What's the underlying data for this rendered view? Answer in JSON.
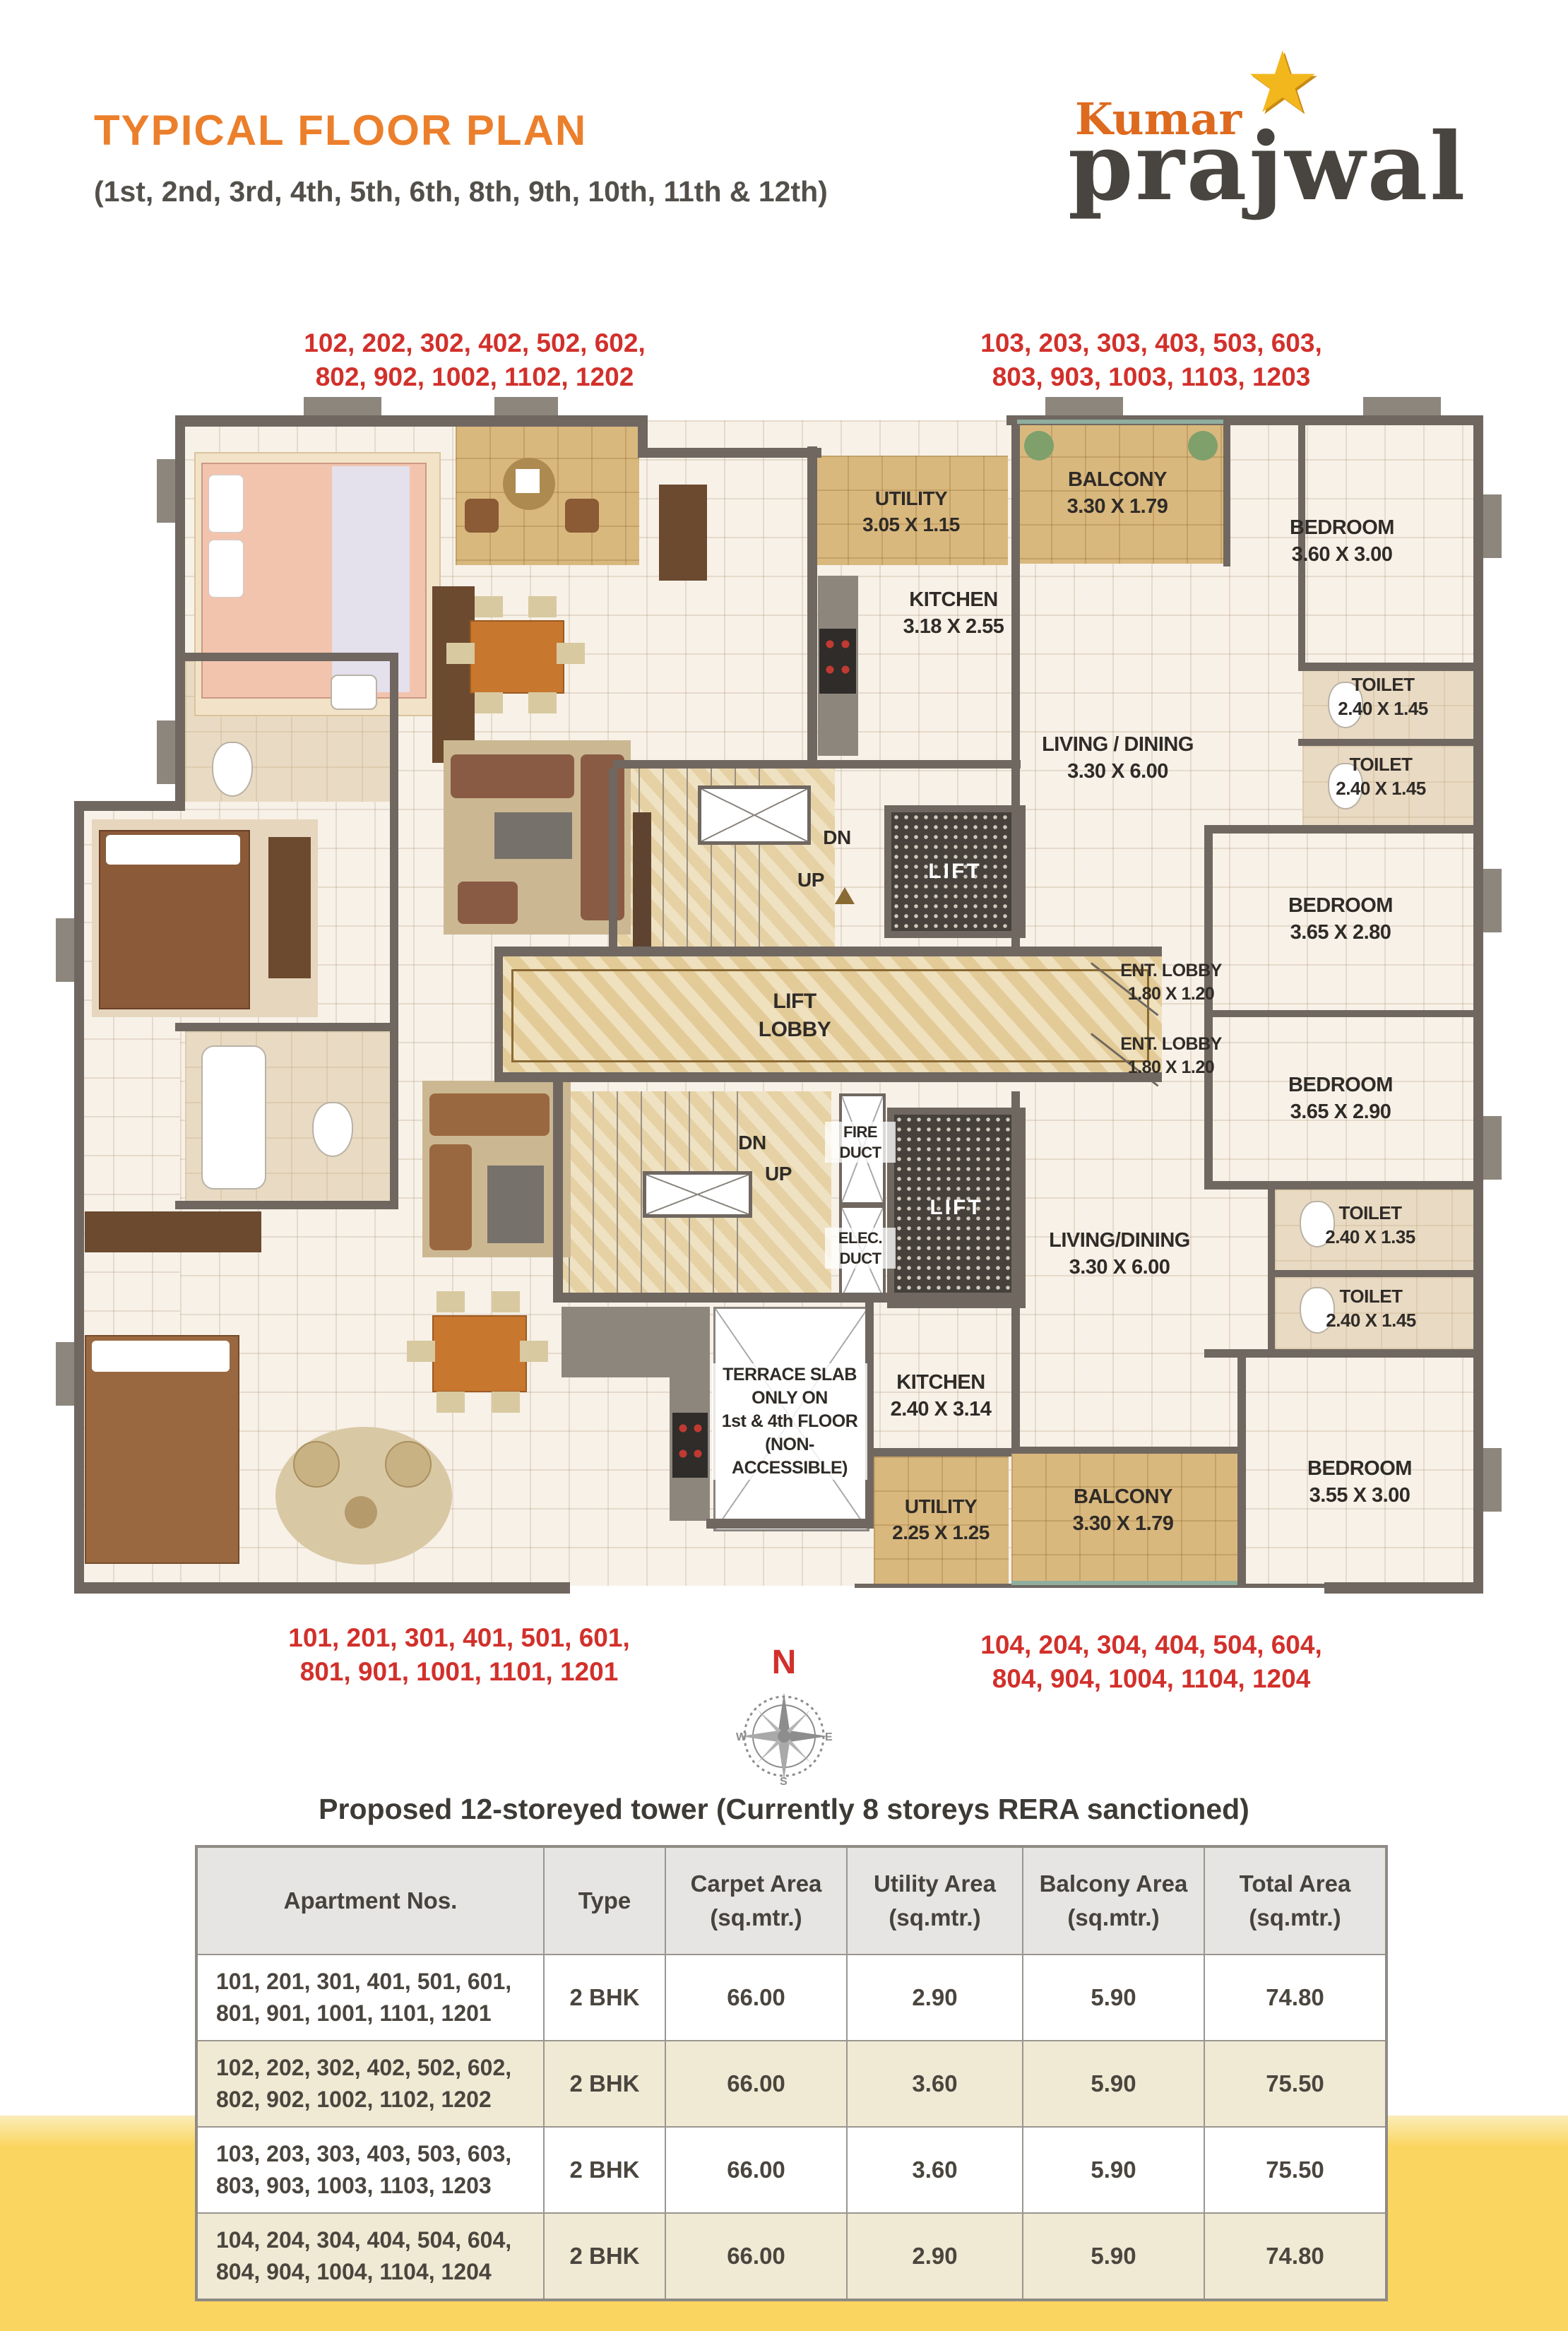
{
  "header": {
    "title": "TYPICAL FLOOR PLAN",
    "subtitle": "(1st, 2nd, 3rd, 4th, 5th, 6th, 8th, 9th, 10th, 11th & 12th)",
    "brand_top": "Kumar",
    "brand_bottom": "prajwal",
    "brand_star": "★"
  },
  "colors": {
    "accent_orange": "#EC7F2B",
    "label_red": "#D2302B",
    "wall_gray": "#6F6760",
    "balcony_tan": "#D9B87E",
    "marble": "#E8D2A2",
    "band_yellow": "#FAD55F",
    "row_cream": "#F0E9D4"
  },
  "plan": {
    "apartment_labels": {
      "top_left": {
        "line1": "102, 202, 302, 402, 502, 602,",
        "line2": "802, 902, 1002, 1102, 1202"
      },
      "top_right": {
        "line1": "103, 203, 303, 403, 503, 603,",
        "line2": "803, 903, 1003, 1103, 1203"
      },
      "bottom_left": {
        "line1": "101, 201, 301, 401, 501, 601,",
        "line2": "801, 901, 1001, 1101, 1201"
      },
      "bottom_right": {
        "line1": "104, 204, 304, 404, 504, 604,",
        "line2": "804, 904, 1004, 1104, 1204"
      }
    },
    "rooms": {
      "utility_top": {
        "name": "UTILITY",
        "dims": "3.05 X 1.15"
      },
      "kitchen_top": {
        "name": "KITCHEN",
        "dims": "3.18 X 2.55"
      },
      "balcony_top": {
        "name": "BALCONY",
        "dims": "3.30 X 1.79"
      },
      "bedroom_tr": {
        "name": "BEDROOM",
        "dims": "3.60 X 3.00"
      },
      "toilet_tr1": {
        "name": "TOILET",
        "dims": "2.40 X 1.45"
      },
      "toilet_tr2": {
        "name": "TOILET",
        "dims": "2.40 X 1.45"
      },
      "living_top": {
        "name": "LIVING / DINING",
        "dims": "3.30 X 6.00"
      },
      "bedroom_r2": {
        "name": "BEDROOM",
        "dims": "3.65 X 2.80"
      },
      "ent_lobby": {
        "name": "ENT. LOBBY",
        "dims": "1.80 X 1.20"
      },
      "bedroom_r3": {
        "name": "BEDROOM",
        "dims": "3.65 X 2.90"
      },
      "living_bottom": {
        "name": "LIVING/DINING",
        "dims": "3.30 X 6.00"
      },
      "toilet_br1": {
        "name": "TOILET",
        "dims": "2.40 X 1.35"
      },
      "toilet_br2": {
        "name": "TOILET",
        "dims": "2.40 X 1.45"
      },
      "kitchen_bottom": {
        "name": "KITCHEN",
        "dims": "2.40 X 3.14"
      },
      "utility_bottom": {
        "name": "UTILITY",
        "dims": "2.25 X 1.25"
      },
      "balcony_bottom": {
        "name": "BALCONY",
        "dims": "3.30 X 1.79"
      },
      "bedroom_br": {
        "name": "BEDROOM",
        "dims": "3.55 X 3.00"
      },
      "lift_lobby": {
        "line1": "LIFT",
        "line2": "LOBBY"
      },
      "lift": "LIFT",
      "dn": "DN",
      "up": "UP",
      "fire_duct": {
        "line1": "FIRE",
        "line2": "DUCT"
      },
      "elec_duct": {
        "line1": "ELEC.",
        "line2": "DUCT"
      },
      "terrace": {
        "line1": "TERRACE  SLAB",
        "line2": "ONLY ON",
        "line3": "1st & 4th FLOOR",
        "line4": "(NON-ACCESSIBLE)"
      }
    },
    "compass": {
      "n": "N",
      "w": "W",
      "e": "E",
      "s": "S"
    }
  },
  "caption": "Proposed 12-storeyed tower (Currently 8 storeys RERA sanctioned)",
  "table": {
    "headers": [
      {
        "title": "Apartment Nos.",
        "unit": ""
      },
      {
        "title": "Type",
        "unit": ""
      },
      {
        "title": "Carpet Area",
        "unit": "(sq.mtr.)"
      },
      {
        "title": "Utility Area",
        "unit": "(sq.mtr.)"
      },
      {
        "title": "Balcony Area",
        "unit": "(sq.mtr.)"
      },
      {
        "title": "Total Area",
        "unit": "(sq.mtr.)"
      }
    ],
    "rows": [
      {
        "apts_line1": "101, 201, 301, 401, 501, 601,",
        "apts_line2": "801, 901, 1001, 1101, 1201",
        "type": "2 BHK",
        "carpet": "66.00",
        "utility": "2.90",
        "balcony": "5.90",
        "total": "74.80"
      },
      {
        "apts_line1": "102, 202, 302, 402, 502, 602,",
        "apts_line2": "802, 902, 1002, 1102, 1202",
        "type": "2 BHK",
        "carpet": "66.00",
        "utility": "3.60",
        "balcony": "5.90",
        "total": "75.50"
      },
      {
        "apts_line1": "103, 203, 303, 403, 503, 603,",
        "apts_line2": "803, 903, 1003, 1103, 1203",
        "type": "2 BHK",
        "carpet": "66.00",
        "utility": "3.60",
        "balcony": "5.90",
        "total": "75.50"
      },
      {
        "apts_line1": "104, 204, 304, 404, 504, 604,",
        "apts_line2": "804, 904, 1004, 1104, 1204",
        "type": "2 BHK",
        "carpet": "66.00",
        "utility": "2.90",
        "balcony": "5.90",
        "total": "74.80"
      }
    ]
  }
}
